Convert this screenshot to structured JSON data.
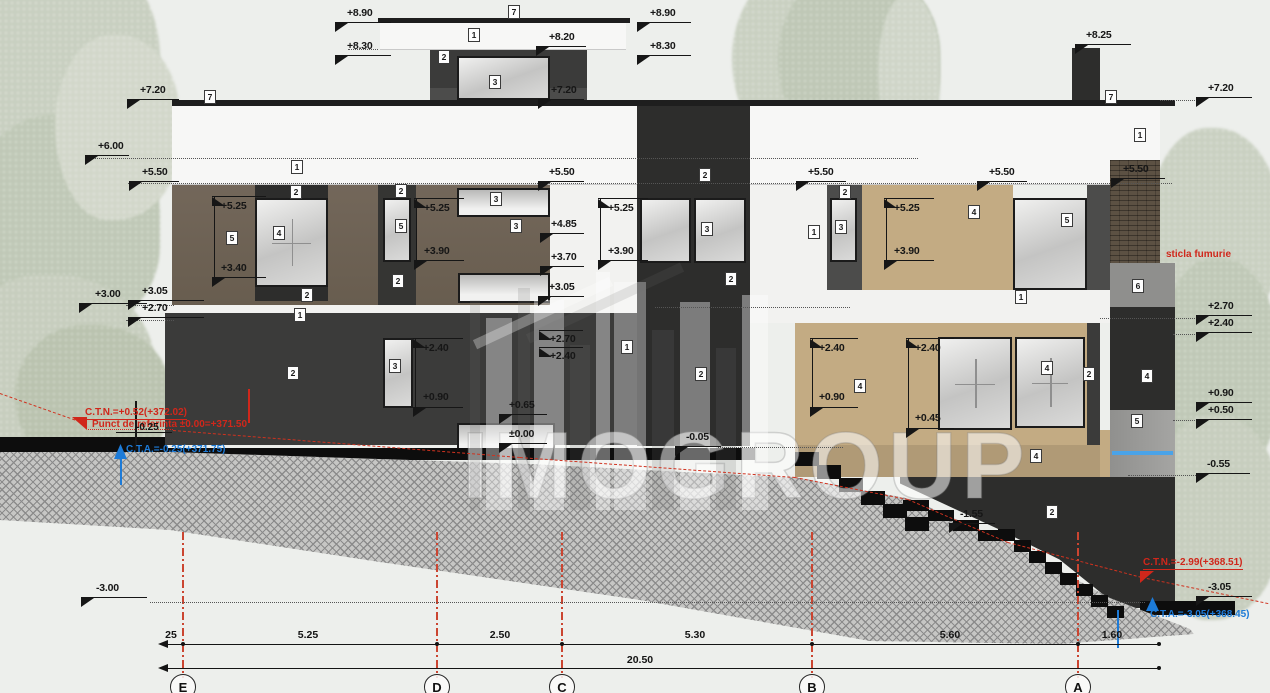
{
  "drawing": {
    "watermark": "IMOGROUP",
    "elevation_markers": [
      {
        "t": "+8.90",
        "lx": 335,
        "ly": 22,
        "lw": 56,
        "tx": 347,
        "ty": 7,
        "tr": "dl"
      },
      {
        "t": "+8.30",
        "lx": 335,
        "ly": 55,
        "lw": 56,
        "tx": 347,
        "ty": 40,
        "tr": "dl"
      },
      {
        "t": "+7.20",
        "lx": 127,
        "ly": 99,
        "lw": 52,
        "tx": 140,
        "ty": 84,
        "tr": "dl"
      },
      {
        "t": "+6.00",
        "lx": 85,
        "ly": 155,
        "lw": 44,
        "tx": 98,
        "ty": 140,
        "tr": "dl"
      },
      {
        "t": "+5.50",
        "lx": 129,
        "ly": 181,
        "lw": 50,
        "tx": 142,
        "ty": 166,
        "tr": "dl"
      },
      {
        "t": "+3.00",
        "lx": 79,
        "ly": 303,
        "lw": 68,
        "tx": 95,
        "ty": 288,
        "tr": "dl"
      },
      {
        "t": "+3.05",
        "lx": 128,
        "ly": 300,
        "lw": 76,
        "tx": 142,
        "ty": 285,
        "tr": "dl"
      },
      {
        "t": "+2.70",
        "lx": 128,
        "ly": 317,
        "lw": 76,
        "tx": 142,
        "ty": 302,
        "tr": "dl"
      },
      {
        "t": "-3.00",
        "lx": 81,
        "ly": 597,
        "lw": 66,
        "tx": 96,
        "ty": 582,
        "tr": "dl"
      },
      {
        "t": "+8.20",
        "lx": 536,
        "ly": 46,
        "lw": 50,
        "tx": 549,
        "ty": 31,
        "tr": "dl"
      },
      {
        "t": "+7.20",
        "lx": 538,
        "ly": 99,
        "lw": 46,
        "tx": 551,
        "ty": 84,
        "tr": "dl"
      },
      {
        "t": "+8.90",
        "lx": 637,
        "ly": 22,
        "lw": 54,
        "tx": 650,
        "ty": 7,
        "tr": "dl"
      },
      {
        "t": "+8.30",
        "lx": 637,
        "ly": 55,
        "lw": 54,
        "tx": 650,
        "ty": 40,
        "tr": "dl"
      },
      {
        "t": "+5.25",
        "lx": 212,
        "ly": 196,
        "lw": 54,
        "tx": 221,
        "ty": 200,
        "tr": "ul"
      },
      {
        "t": "+3.40",
        "lx": 212,
        "ly": 277,
        "lw": 54,
        "tx": 221,
        "ty": 262,
        "tr": "dl"
      },
      {
        "t": "+5.25",
        "lx": 414,
        "ly": 198,
        "lw": 50,
        "tx": 424,
        "ty": 202,
        "tr": "ul"
      },
      {
        "t": "+3.90",
        "lx": 414,
        "ly": 260,
        "lw": 50,
        "tx": 424,
        "ty": 245,
        "tr": "dl"
      },
      {
        "t": "+5.25",
        "lx": 598,
        "ly": 198,
        "lw": 50,
        "tx": 608,
        "ty": 202,
        "tr": "ul"
      },
      {
        "t": "+3.90",
        "lx": 598,
        "ly": 260,
        "lw": 50,
        "tx": 608,
        "ty": 245,
        "tr": "dl"
      },
      {
        "t": "+4.85",
        "lx": 540,
        "ly": 233,
        "lw": 44,
        "tx": 551,
        "ty": 218,
        "tr": "dl"
      },
      {
        "t": "+3.70",
        "lx": 540,
        "ly": 266,
        "lw": 44,
        "tx": 551,
        "ty": 251,
        "tr": "dl"
      },
      {
        "t": "+3.05",
        "lx": 538,
        "ly": 296,
        "lw": 46,
        "tx": 549,
        "ty": 281,
        "tr": "dl"
      },
      {
        "t": "+5.50",
        "lx": 538,
        "ly": 181,
        "lw": 46,
        "tx": 549,
        "ty": 166,
        "tr": "dl"
      },
      {
        "t": "+5.50",
        "lx": 796,
        "ly": 181,
        "lw": 50,
        "tx": 808,
        "ty": 166,
        "tr": "dl"
      },
      {
        "t": "+5.50",
        "lx": 977,
        "ly": 181,
        "lw": 50,
        "tx": 989,
        "ty": 166,
        "tr": "dl"
      },
      {
        "t": "+5.25",
        "lx": 884,
        "ly": 198,
        "lw": 50,
        "tx": 894,
        "ty": 202,
        "tr": "ul"
      },
      {
        "t": "+3.90",
        "lx": 884,
        "ly": 260,
        "lw": 50,
        "tx": 894,
        "ty": 245,
        "tr": "dl"
      },
      {
        "t": "+2.40",
        "lx": 413,
        "ly": 338,
        "lw": 50,
        "tx": 423,
        "ty": 342,
        "tr": "ul"
      },
      {
        "t": "+0.90",
        "lx": 413,
        "ly": 407,
        "lw": 50,
        "tx": 423,
        "ty": 391,
        "tr": "dl"
      },
      {
        "t": "+2.70",
        "lx": 539,
        "ly": 330,
        "lw": 44,
        "tx": 550,
        "ty": 333,
        "tr": "ul"
      },
      {
        "t": "+2.40",
        "lx": 539,
        "ly": 347,
        "lw": 44,
        "tx": 550,
        "ty": 350,
        "tr": "ul"
      },
      {
        "t": "+0.65",
        "lx": 499,
        "ly": 414,
        "lw": 48,
        "tx": 509,
        "ty": 399,
        "tr": "dl"
      },
      {
        "t": "±0.00",
        "lx": 499,
        "ly": 443,
        "lw": 48,
        "tx": 509,
        "ty": 428,
        "tr": "dl"
      },
      {
        "t": "-0.05",
        "lx": 675,
        "ly": 446,
        "lw": 46,
        "tx": 686,
        "ty": 431,
        "tr": "dl"
      },
      {
        "t": "+2.40",
        "lx": 810,
        "ly": 338,
        "lw": 48,
        "tx": 819,
        "ty": 342,
        "tr": "ul"
      },
      {
        "t": "+0.90",
        "lx": 810,
        "ly": 407,
        "lw": 48,
        "tx": 819,
        "ty": 391,
        "tr": "dl"
      },
      {
        "t": "+2.40",
        "lx": 906,
        "ly": 338,
        "lw": 48,
        "tx": 915,
        "ty": 342,
        "tr": "ul"
      },
      {
        "t": "+0.45",
        "lx": 906,
        "ly": 428,
        "lw": 48,
        "tx": 915,
        "ty": 412,
        "tr": "dl"
      },
      {
        "t": "-1.55",
        "lx": 949,
        "ly": 523,
        "lw": 46,
        "tx": 960,
        "ty": 508,
        "tr": "dl"
      },
      {
        "t": "+8.25",
        "lx": 1075,
        "ly": 44,
        "lw": 56,
        "tx": 1086,
        "ty": 29,
        "tr": "dl"
      },
      {
        "t": "+7.20",
        "lx": 1196,
        "ly": 97,
        "lw": 56,
        "tx": 1208,
        "ty": 82,
        "tr": "dl"
      },
      {
        "t": "+5.50",
        "lx": 1111,
        "ly": 178,
        "lw": 54,
        "tx": 1123,
        "ty": 163,
        "tr": "dl"
      },
      {
        "t": "+2.70",
        "lx": 1196,
        "ly": 315,
        "lw": 56,
        "tx": 1208,
        "ty": 300,
        "tr": "dl"
      },
      {
        "t": "+2.40",
        "lx": 1196,
        "ly": 332,
        "lw": 56,
        "tx": 1208,
        "ty": 317,
        "tr": "dl"
      },
      {
        "t": "+0.90",
        "lx": 1196,
        "ly": 402,
        "lw": 56,
        "tx": 1208,
        "ty": 387,
        "tr": "dl"
      },
      {
        "t": "+0.50",
        "lx": 1196,
        "ly": 419,
        "lw": 56,
        "tx": 1208,
        "ty": 404,
        "tr": "dl"
      },
      {
        "t": "-0.55",
        "lx": 1196,
        "ly": 473,
        "lw": 54,
        "tx": 1207,
        "ty": 458,
        "tr": "dl"
      },
      {
        "t": "-3.05",
        "lx": 1196,
        "ly": 596,
        "lw": 56,
        "tx": 1208,
        "ty": 581,
        "tr": "dl"
      }
    ],
    "ref_labels": [
      {
        "t": "7",
        "x": 508,
        "y": 5
      },
      {
        "t": "1",
        "x": 468,
        "y": 28
      },
      {
        "t": "2",
        "x": 438,
        "y": 50
      },
      {
        "t": "3",
        "x": 489,
        "y": 75
      },
      {
        "t": "7",
        "x": 204,
        "y": 90
      },
      {
        "t": "1",
        "x": 291,
        "y": 160
      },
      {
        "t": "7",
        "x": 1105,
        "y": 90
      },
      {
        "t": "1",
        "x": 1134,
        "y": 128
      },
      {
        "t": "2",
        "x": 290,
        "y": 185
      },
      {
        "t": "4",
        "x": 273,
        "y": 226
      },
      {
        "t": "5",
        "x": 226,
        "y": 231
      },
      {
        "t": "2",
        "x": 301,
        "y": 288
      },
      {
        "t": "1",
        "x": 294,
        "y": 308
      },
      {
        "t": "2",
        "x": 395,
        "y": 184
      },
      {
        "t": "5",
        "x": 395,
        "y": 219
      },
      {
        "t": "2",
        "x": 392,
        "y": 274
      },
      {
        "t": "3",
        "x": 490,
        "y": 192
      },
      {
        "t": "3",
        "x": 510,
        "y": 219
      },
      {
        "t": "2",
        "x": 699,
        "y": 168
      },
      {
        "t": "3",
        "x": 701,
        "y": 222
      },
      {
        "t": "2",
        "x": 725,
        "y": 272
      },
      {
        "t": "1",
        "x": 808,
        "y": 225
      },
      {
        "t": "2",
        "x": 839,
        "y": 185
      },
      {
        "t": "3",
        "x": 835,
        "y": 220
      },
      {
        "t": "4",
        "x": 968,
        "y": 205
      },
      {
        "t": "5",
        "x": 1061,
        "y": 213
      },
      {
        "t": "1",
        "x": 1015,
        "y": 290
      },
      {
        "t": "6",
        "x": 1132,
        "y": 279
      },
      {
        "t": "2",
        "x": 287,
        "y": 366
      },
      {
        "t": "3",
        "x": 389,
        "y": 359
      },
      {
        "t": "1",
        "x": 621,
        "y": 340
      },
      {
        "t": "2",
        "x": 695,
        "y": 367
      },
      {
        "t": "4",
        "x": 854,
        "y": 379
      },
      {
        "t": "4",
        "x": 1041,
        "y": 361
      },
      {
        "t": "2",
        "x": 1083,
        "y": 367
      },
      {
        "t": "4",
        "x": 1030,
        "y": 449
      },
      {
        "t": "4",
        "x": 1141,
        "y": 369
      },
      {
        "t": "5",
        "x": 1131,
        "y": 414
      },
      {
        "t": "2",
        "x": 1046,
        "y": 505
      }
    ],
    "annotations": [
      {
        "t": "C.T.N.=+0.52(+372.02)",
        "x": 85,
        "y": 407,
        "c": "red",
        "u": true
      },
      {
        "t": "Punct de referinta ±0.00=+371.50",
        "x": 92,
        "y": 419,
        "c": "red"
      },
      {
        "t": "-0.25",
        "x": 136,
        "y": 422,
        "c": "blackt"
      },
      {
        "t": "sticla fumurie",
        "x": 1166,
        "y": 249,
        "c": "red"
      },
      {
        "t": "C.T.N.=-2.99(+368.51)",
        "x": 1143,
        "y": 557,
        "c": "red",
        "u": true
      },
      {
        "t": "C.T.A.=-0.25(+371.75)",
        "x": 126,
        "y": 444,
        "c": "blue-t"
      },
      {
        "t": "C.T.A.=-3.05(+368.45)",
        "x": 1150,
        "y": 609,
        "c": "blue-t"
      }
    ],
    "dimensions": {
      "row1": [
        {
          "t": "25",
          "cx": 171
        },
        {
          "t": "5.25",
          "cx": 308
        },
        {
          "t": "2.50",
          "cx": 500
        },
        {
          "t": "5.30",
          "cx": 695
        },
        {
          "t": "5.60",
          "cx": 950
        },
        {
          "t": "1.60",
          "cx": 1112
        }
      ],
      "total": {
        "t": "20.50",
        "cx": 640
      },
      "ticks": [
        183,
        437,
        562,
        812,
        1078
      ]
    },
    "grid_bubbles": [
      {
        "t": "E",
        "x": 183
      },
      {
        "t": "D",
        "x": 437
      },
      {
        "t": "C",
        "x": 562
      },
      {
        "t": "B",
        "x": 812
      },
      {
        "t": "A",
        "x": 1078
      }
    ]
  }
}
